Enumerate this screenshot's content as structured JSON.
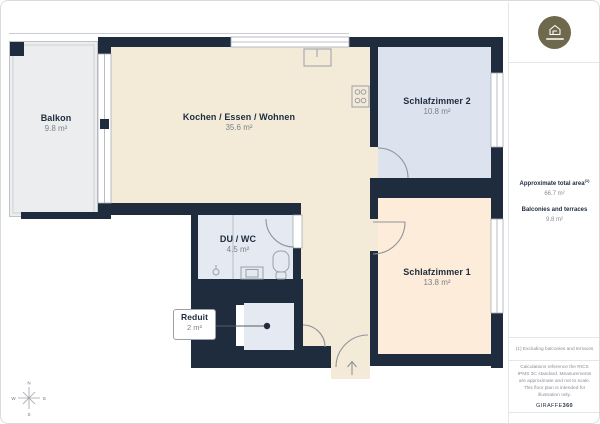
{
  "rooms": [
    {
      "name": "Balkon",
      "area": "9.8 m²"
    },
    {
      "name": "Kochen / Essen / Wohnen",
      "area": "35.6 m²"
    },
    {
      "name": "Schlafzimmer 2",
      "area": "10.8 m²"
    },
    {
      "name": "DU / WC",
      "area": "4.5 m²"
    },
    {
      "name": "Schlafzimmer 1",
      "area": "13.8 m²"
    },
    {
      "name": "Reduit",
      "area": "2 m²"
    }
  ],
  "sidebar": {
    "total_area_label": "Approximate total area",
    "total_area_marker": "(1)",
    "total_area_value": "66.7 m²",
    "balconies_label": "Balconies and terraces",
    "balconies_value": "9.8 m²",
    "footnote": "(1) Excluding balconies and terraces",
    "disclaimer": "Calculations reference the RICS IPMS 3C standard. Measurements are approximate and not to scale. This floor plan is intended for illustration only.",
    "brand_name": "GIRAFFE",
    "brand_suffix": "360"
  },
  "compass": {
    "n": "N",
    "e": "E",
    "s": "S",
    "w": "W"
  },
  "colors": {
    "wall": "#1f2c3e",
    "living": "#f3ead8",
    "bedroom1": "#fcecd9",
    "bedroom2": "#dce3ef",
    "wet_room": "#e4e9f2",
    "balcony": "#ebedee",
    "logo": "#6e684c"
  }
}
